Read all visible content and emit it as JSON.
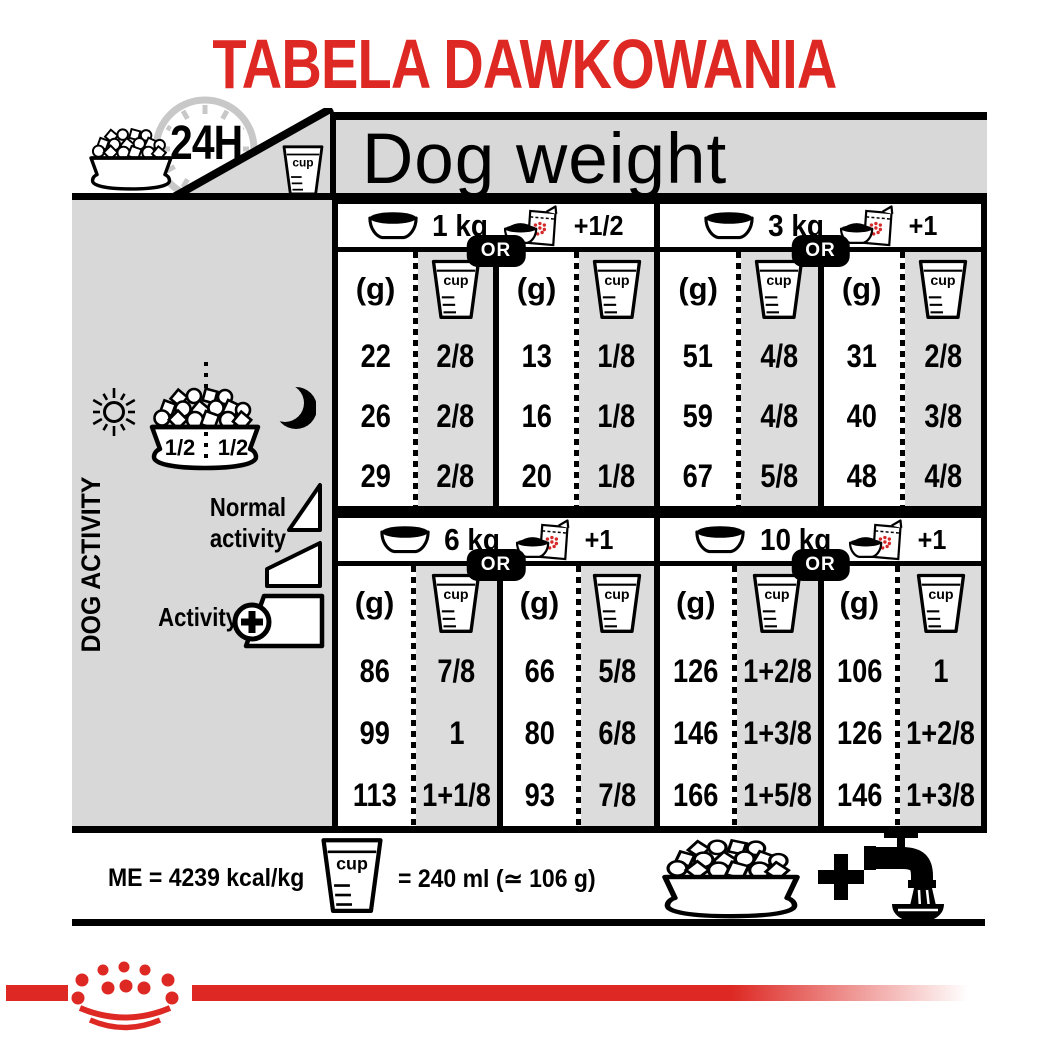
{
  "title": "TABELA DAWKOWANIA",
  "header": {
    "hours_label": "24H",
    "cup_label": "cup",
    "dog_weight_label": "Dog weight"
  },
  "activity_panel": {
    "label": "DOG ACTIVITY",
    "half_left": "1/2",
    "half_right": "1/2",
    "normal_activity_label": "Normal activity",
    "activity_label": "Activity",
    "activity_plus": "+"
  },
  "table": {
    "or_label": "OR",
    "grams_header": "(g)",
    "cup_header": "cup",
    "sections": [
      {
        "weight": "1 kg",
        "wet_extra": "+1/2",
        "dry": {
          "grams": [
            "22",
            "26",
            "29"
          ],
          "cups": [
            "2/8",
            "2/8",
            "2/8"
          ]
        },
        "with_wet": {
          "grams": [
            "13",
            "16",
            "20"
          ],
          "cups": [
            "1/8",
            "1/8",
            "1/8"
          ]
        }
      },
      {
        "weight": "3 kg",
        "wet_extra": "+1",
        "dry": {
          "grams": [
            "51",
            "59",
            "67"
          ],
          "cups": [
            "4/8",
            "4/8",
            "5/8"
          ]
        },
        "with_wet": {
          "grams": [
            "31",
            "40",
            "48"
          ],
          "cups": [
            "2/8",
            "3/8",
            "4/8"
          ]
        }
      },
      {
        "weight": "6 kg",
        "wet_extra": "+1",
        "dry": {
          "grams": [
            "86",
            "99",
            "113"
          ],
          "cups": [
            "7/8",
            "1",
            "1+1/8"
          ]
        },
        "with_wet": {
          "grams": [
            "66",
            "80",
            "93"
          ],
          "cups": [
            "5/8",
            "6/8",
            "7/8"
          ]
        }
      },
      {
        "weight": "10 kg",
        "wet_extra": "+1",
        "dry": {
          "grams": [
            "126",
            "146",
            "166"
          ],
          "cups": [
            "1+2/8",
            "1+3/8",
            "1+5/8"
          ]
        },
        "with_wet": {
          "grams": [
            "106",
            "126",
            "146"
          ],
          "cups": [
            "1",
            "1+2/8",
            "1+3/8"
          ]
        }
      }
    ]
  },
  "footer": {
    "me_label": "ME = 4239 kcal/kg",
    "cup_label": "cup",
    "cup_equiv_label": "= 240 ml (≃ 106 g)",
    "plus": "+"
  },
  "colors": {
    "accent_red": "#dd2823",
    "panel_gray": "#d8d8d8",
    "strip_gray": "#dcdcdc"
  }
}
